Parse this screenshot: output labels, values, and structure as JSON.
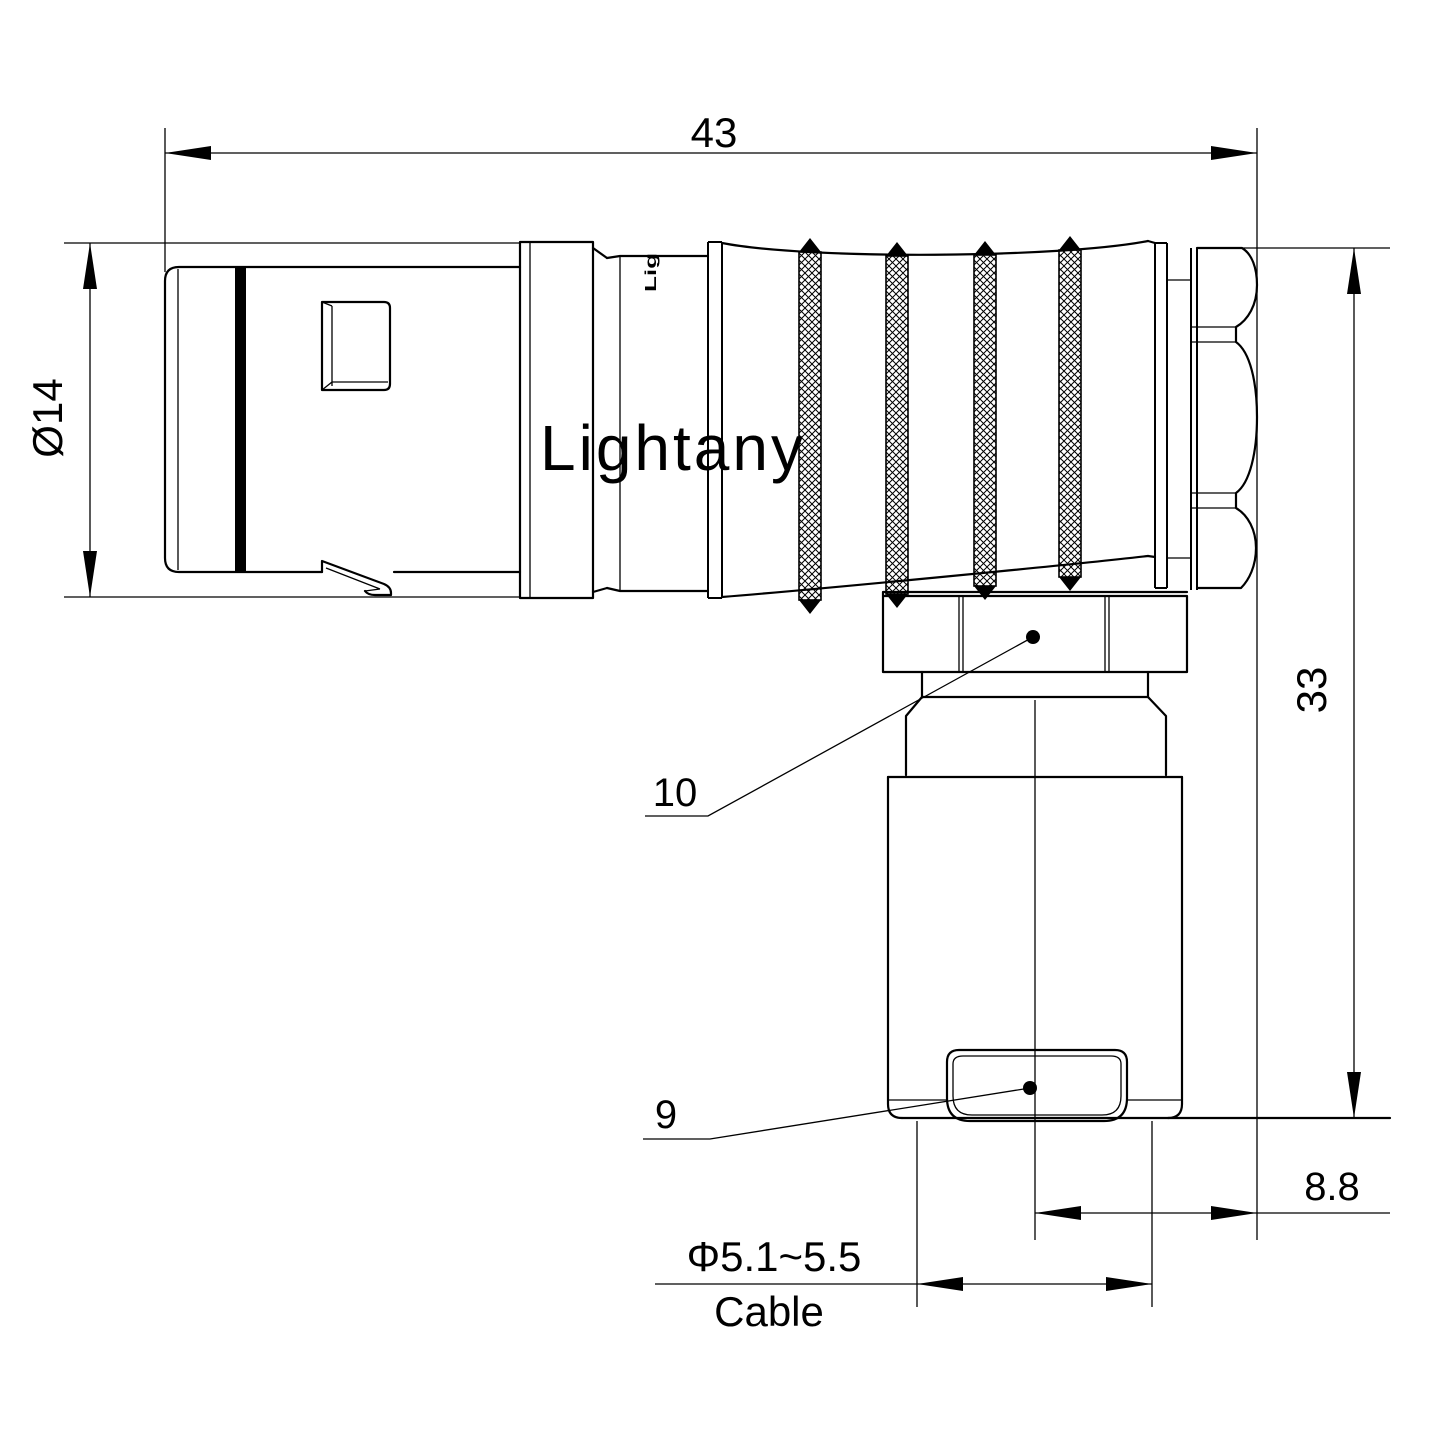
{
  "drawing": {
    "watermark": "Lightany",
    "body_marking": "Lig",
    "dimensions": {
      "overall_length": "43",
      "barrel_diameter": "Ø14",
      "height": "33",
      "rear_offset": "8.8",
      "cable_diameter": "Φ5.1~5.5",
      "cable_label": "Cable",
      "callout_nut": "10",
      "callout_boot": "9"
    },
    "colors": {
      "line": "#000000",
      "background": "#ffffff",
      "watermark": "#f6cfcb"
    }
  }
}
